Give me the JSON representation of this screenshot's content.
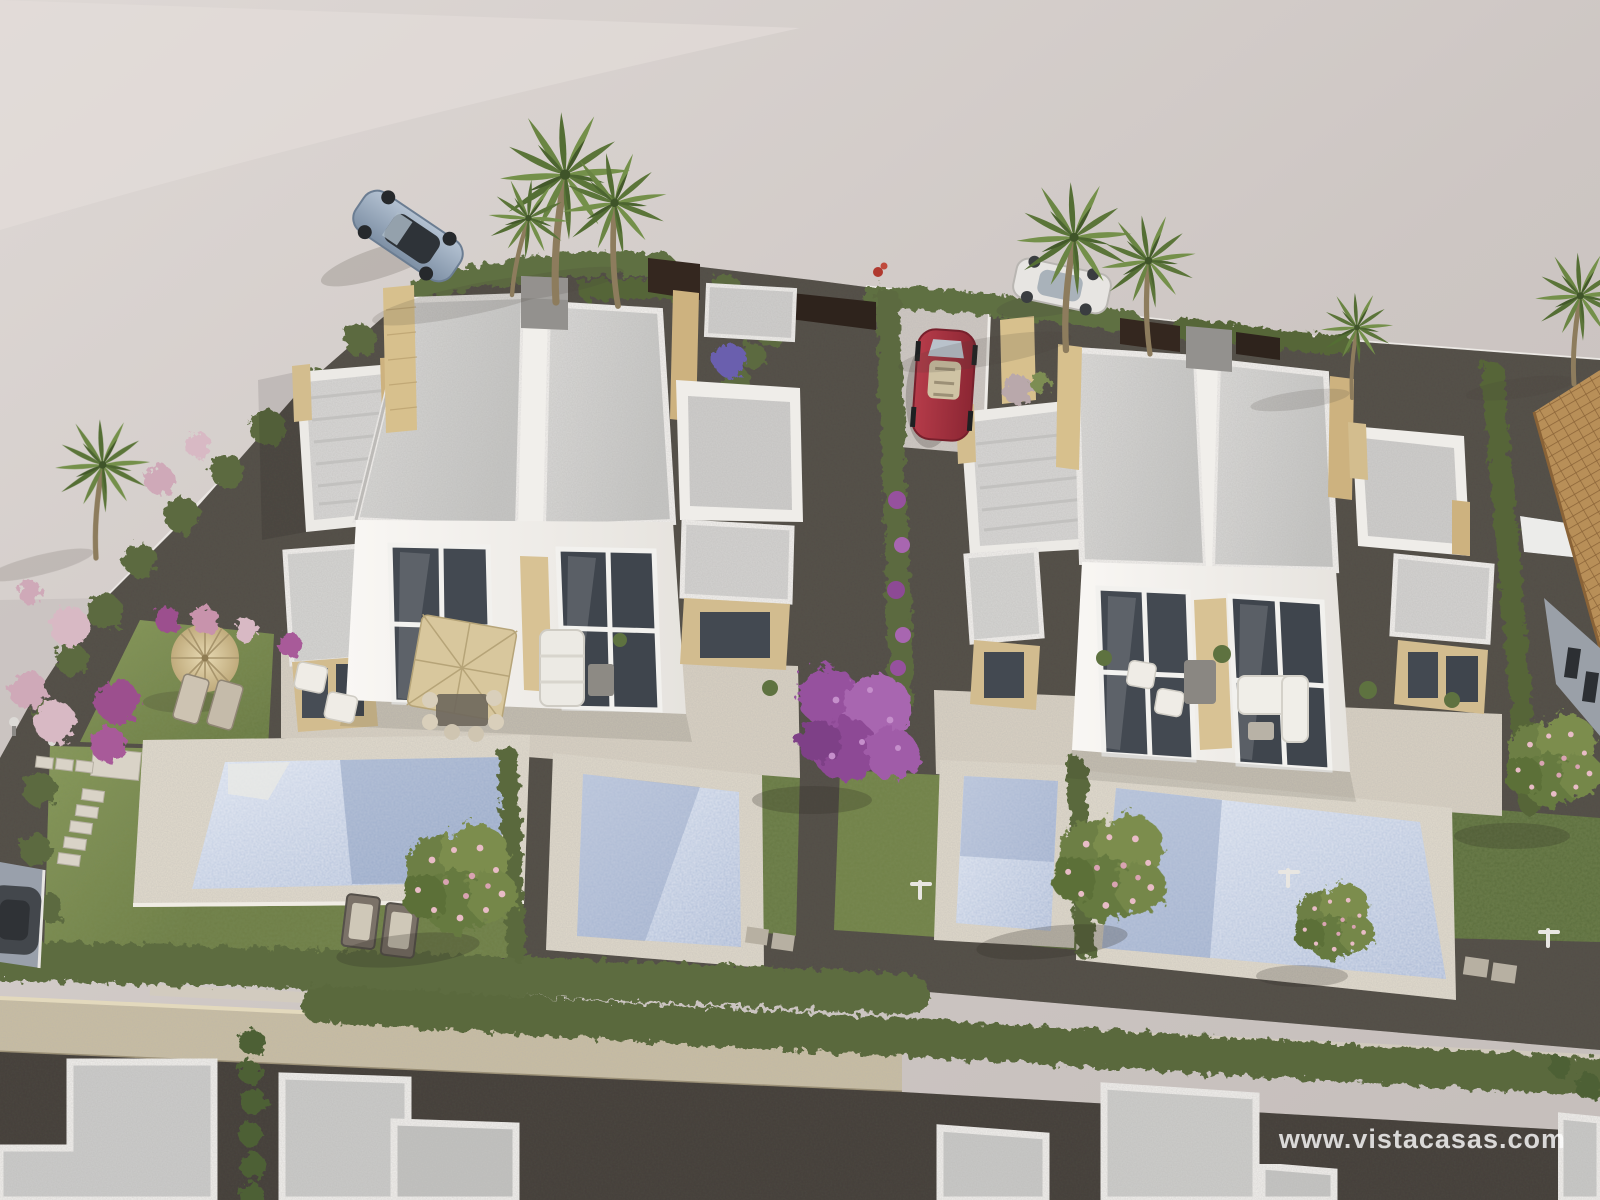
{
  "watermark": {
    "text": "www.vistacasas.com"
  },
  "image": {
    "kind": "3d-aerial-architectural-rendering",
    "subject": "New-build residential development: two white modern semi-detached villas with private pools, landscaped gardens, perimeter hedges and stone wall, cars on surrounding street"
  },
  "palette": {
    "road": "#cdc6c3",
    "road_light": "#e0dad7",
    "roof_slab": "#d5d4d2",
    "parapet_white": "#f4f2ef",
    "facade_white": "#f7f5f2",
    "sandstone": "#d3bd8e",
    "pool_water": "#b3c1da",
    "pool_deck": "#e2dbcd",
    "terrace": "#d9d1c3",
    "lawn": "#7c8b51",
    "hedge": "#5d6c40",
    "gravel": "#49453e",
    "stone_wall": "#c9bda0",
    "tile_roof": "#b88f58",
    "car_red": "#a33040",
    "car_silver": "#9eadbe",
    "car_white": "#e7e5e2",
    "bougainvillea": "#9c5fa5",
    "blossom_pink": "#e3b4bf"
  },
  "scene": {
    "villas": [
      {
        "id": "villa-left",
        "units": 2,
        "pools": 2
      },
      {
        "id": "villa-right",
        "units": 2,
        "pools": 2
      }
    ],
    "cars": [
      {
        "id": "sports-car-silver",
        "location": "street top-left"
      },
      {
        "id": "hatchback-white",
        "location": "street top-right behind palms"
      },
      {
        "id": "convertible-red",
        "location": "driveway between villas"
      },
      {
        "id": "car-dark",
        "location": "left edge driveway"
      }
    ],
    "vegetation": {
      "palm_clusters": 6,
      "blossom_trees": 4,
      "bougainvillea_trees": 1
    },
    "other": "stone perimeter wall, stepping-stone path, straw parasol with loungers, outdoor dining and sofa sets, row of rooftops along bottom edge"
  }
}
